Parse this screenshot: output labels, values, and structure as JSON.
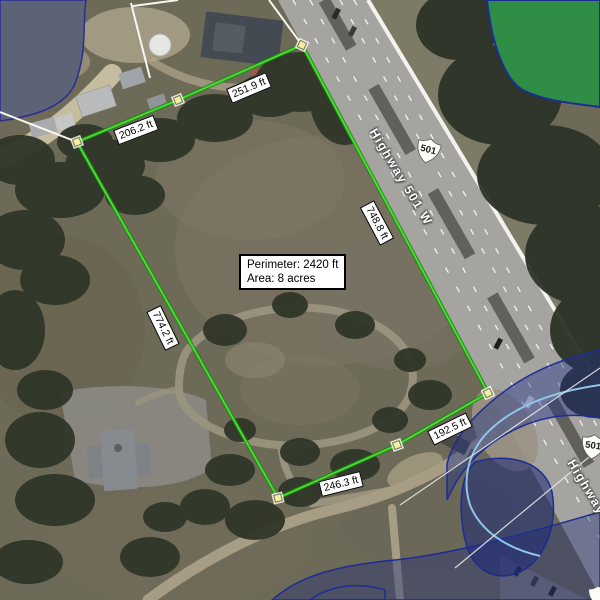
{
  "measure": {
    "segments": [
      {
        "name": "northwest-side",
        "label": "206.2 ft"
      },
      {
        "name": "north-side",
        "label": "251.9 ft"
      },
      {
        "name": "highway-side",
        "label": "748.8 ft"
      },
      {
        "name": "southeast-side",
        "label": "192.5 ft"
      },
      {
        "name": "south-side",
        "label": "246.3 ft"
      },
      {
        "name": "west-side",
        "label": "774.2 ft"
      }
    ],
    "summary": {
      "perimeter_label": "Perimeter: 2420 ft",
      "area_label": "Area: 8 acres"
    },
    "line_color": "#44dd30",
    "vertex_color": "#f3eea2"
  },
  "roads": {
    "highway_label": "Highway 501 W",
    "route_shield": "501"
  },
  "overlays": {
    "water_outline_color": "#1c2e96",
    "pond_fill_color": "#5d6377",
    "greenspace_fill_color": "#2f8d45",
    "stream_line_color": "#8fc6ec"
  }
}
